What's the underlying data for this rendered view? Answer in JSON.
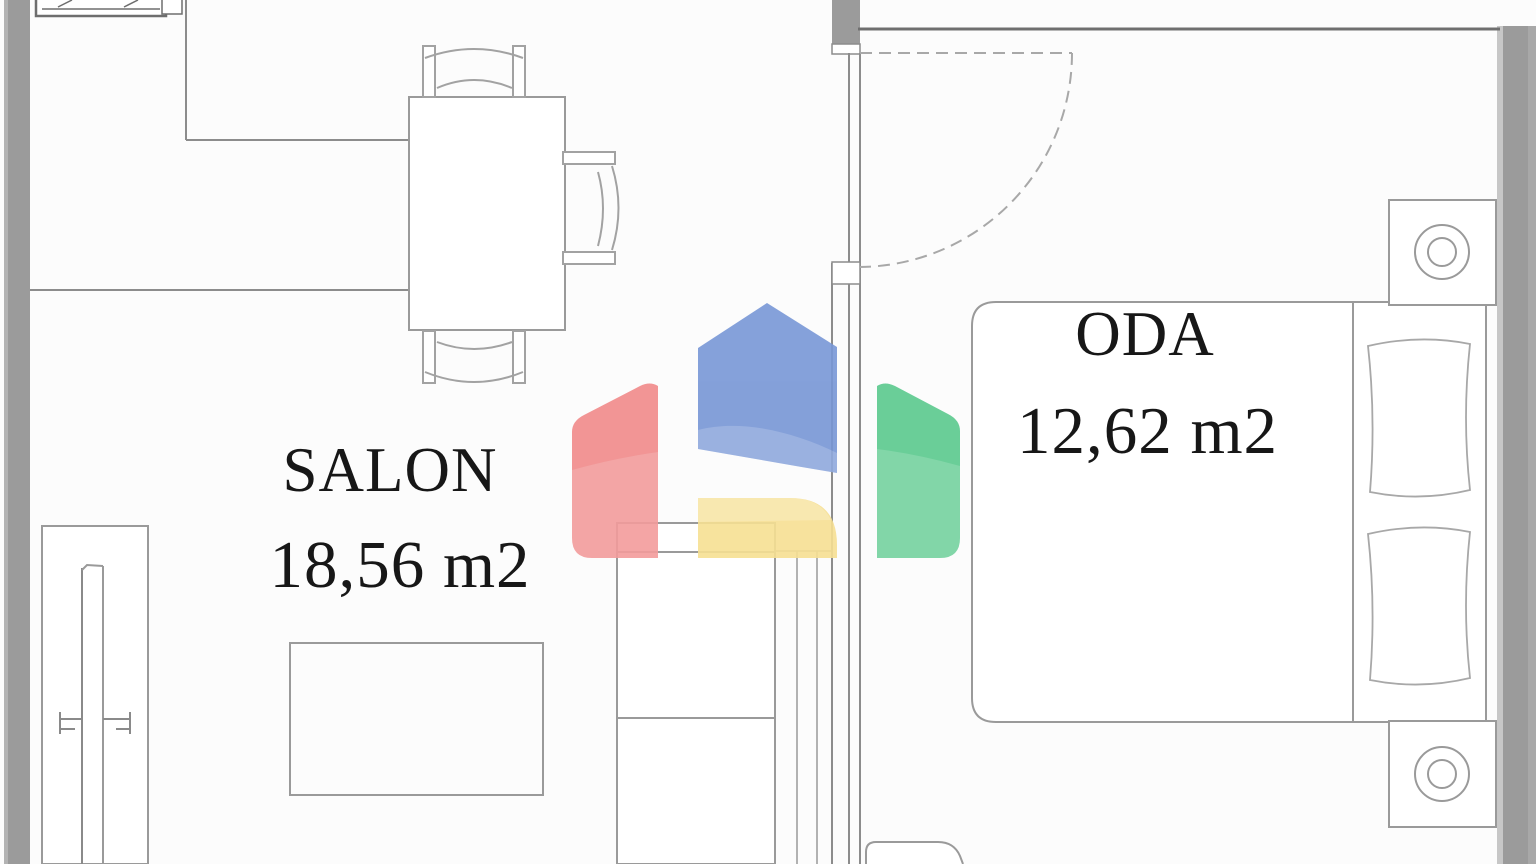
{
  "rooms": {
    "salon": {
      "name": "SALON",
      "area": "18,56 m2"
    },
    "oda": {
      "name": "ODA",
      "area": "12,62 m2"
    }
  },
  "watermark": {
    "icon": "house-logo",
    "colors": {
      "roof_blue": "#7897d6",
      "left_red": "#f18a8a",
      "right_green": "#5bca8e",
      "base_yellow": "#f7e093"
    }
  },
  "palette": {
    "wall_gray": "#9b9b9b",
    "line_gray": "#9a9a9a",
    "dark_line": "#6f6f6f",
    "text_color": "#171717",
    "background": "#fcfcfc"
  }
}
